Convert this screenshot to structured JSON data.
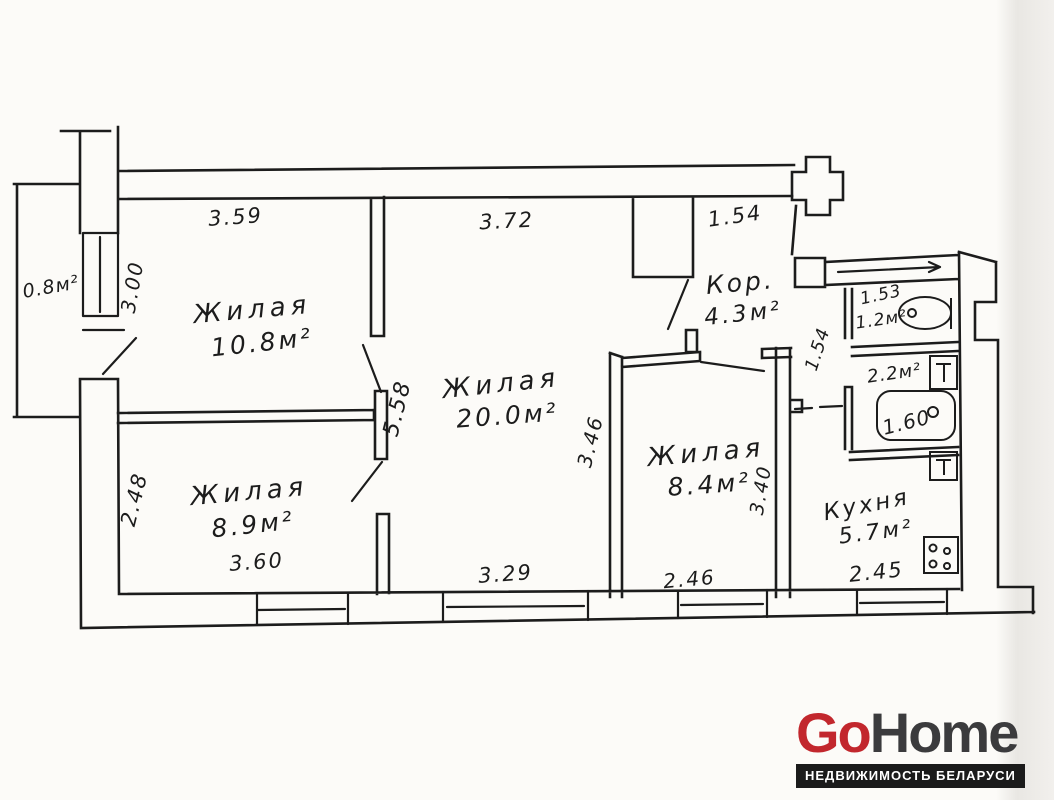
{
  "watermark": {
    "brand_go": "Go",
    "brand_home": "Home",
    "tagline": "НЕДВИЖИМОСТЬ БЕЛАРУСИ",
    "colors": {
      "go": "#c2272d",
      "home": "#3b3b3d",
      "bar_bg": "#1b1b1b",
      "bar_text": "#ffffff"
    }
  },
  "plan": {
    "ink_color": "#1c1c1c",
    "rooms": {
      "living1": {
        "label": "Жилая",
        "area": "10.8м²"
      },
      "living2": {
        "label": "Жилая",
        "area": "20.0м²"
      },
      "living3": {
        "label": "Жилая",
        "area": "8.9м²"
      },
      "living4": {
        "label": "Жилая",
        "area": "8.4м²"
      },
      "corridor": {
        "label": "Кор.",
        "area": "4.3м²"
      },
      "kitchen": {
        "label": "Кухня",
        "area": "5.7м²"
      },
      "wc": {
        "area": "1.2м²"
      },
      "bathroom": {
        "area": "2.2м²"
      },
      "balcony": {
        "area": "0.8м²"
      }
    },
    "dims": {
      "living1_width": "3.59",
      "living2_width_top": "3.72",
      "hall_width_top": "1.54",
      "balcony_height": "3.00",
      "living2_height": "5.58",
      "living2_width_bottom": "3.29",
      "living3_height": "2.48",
      "living3_width": "3.60",
      "living4_height_left": "3.46",
      "living4_height_right": "3.40",
      "living4_width": "2.46",
      "kitchen_width": "2.45",
      "wc_width": "1.53",
      "hall_passage_width": "1.54",
      "bath_length": "1.60"
    }
  }
}
